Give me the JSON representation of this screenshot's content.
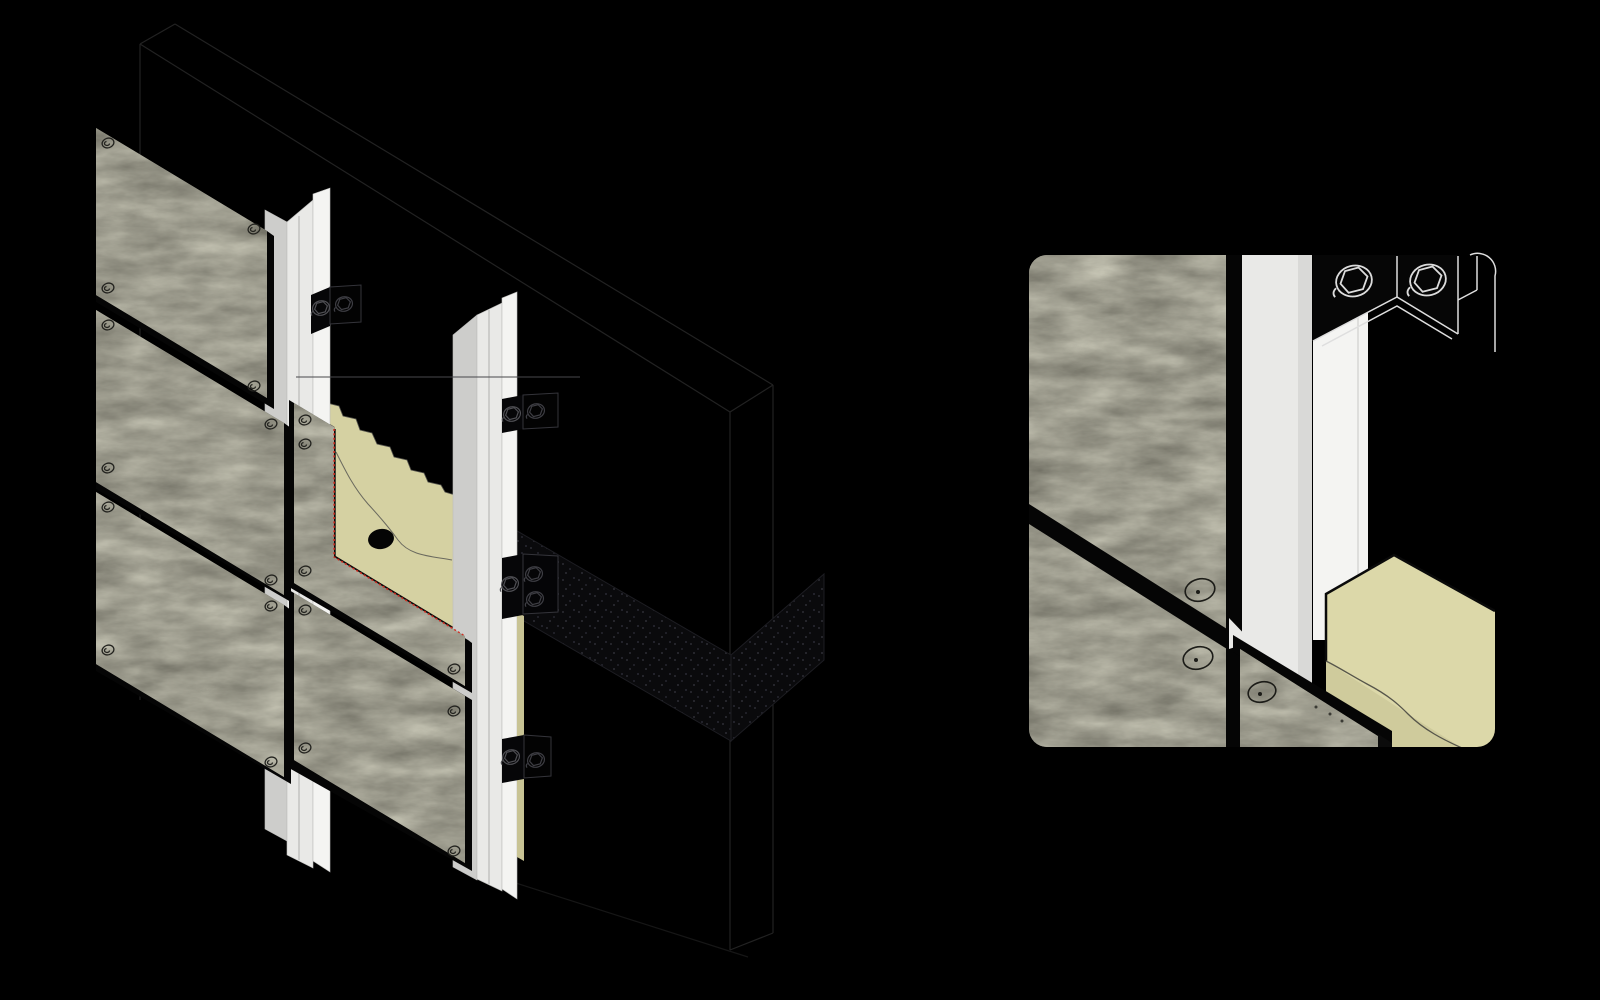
{
  "meta": {
    "description": "Isometric construction diagram of a ventilated facade system with a joint detail callout",
    "text_content": "none"
  },
  "figures": {
    "main": {
      "name": "axonometric-facade-assembly"
    },
    "detail": {
      "name": "joint-detail-callout"
    }
  },
  "components": {
    "wall": "concrete-substrate-wall",
    "slab_band": "speckled-slab-edge-band",
    "insulation": "mineral-wool-insulation",
    "anchor_hole": "insulation-anchor-hole",
    "profile": "vertical-t-profile-rail",
    "bracket": "wall-bracket",
    "bolt": "hex-bolt",
    "panel": "fiber-cement-facade-panel",
    "screw": "panel-rivet",
    "cut_line": "red-section-cut-line",
    "datum_line": "horizontal-datum-line",
    "torn_edge": "insulation-torn-edge",
    "wavy_line": "insulation-tear-line"
  },
  "colors": {
    "background": "#000000",
    "panel_base": "#99988b",
    "panel_joint": "#050505",
    "insulation": "#d5d1a2",
    "insulation_front": "#cfcb9c",
    "insulation_top": "#dcd8a9",
    "insulation_edge": "#c8c394",
    "profile_front": "#e9e9e7",
    "profile_side": "#cdcdcb",
    "profile_back": "#f4f4f2",
    "cut_line": "#d3281c",
    "slab_band": "#0a0a0c",
    "slab_dot": "#24242a",
    "wall_outline": "#222222",
    "bolt_dark": "#4f4f54",
    "bolt_light": "#d8d8d8",
    "screw_outline": "#23231f",
    "tear_line": "#56554a"
  }
}
